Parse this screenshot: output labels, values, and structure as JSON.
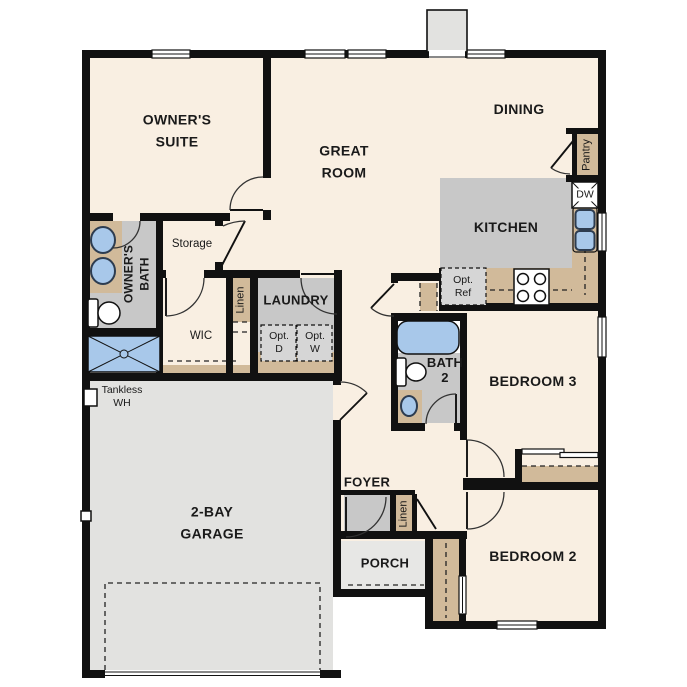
{
  "floorplan": {
    "rooms": {
      "owners_suite": "OWNER'S\nSUITE",
      "great_room": "GREAT\nROOM",
      "dining": "DINING",
      "kitchen": "KITCHEN",
      "laundry": "LAUNDRY",
      "bath2": "BATH\n2",
      "bedroom3": "BEDROOM 3",
      "bedroom2": "BEDROOM 2",
      "foyer": "FOYER",
      "porch": "PORCH",
      "garage": "2-BAY\nGARAGE",
      "wic": "WIC",
      "storage": "Storage",
      "owners_bath": "OWNER'S\nBATH"
    },
    "closets": {
      "linen_upper": "Linen",
      "linen_lower": "Linen",
      "pantry": "Pantry"
    },
    "appliances": {
      "dw": "DW",
      "opt_d": "Opt.\nD",
      "opt_w": "Opt.\nW",
      "opt_ref": "Opt.\nRef",
      "tankless_wh": "Tankless\nWH"
    },
    "colors": {
      "wall": "#111111",
      "floor": "#f9efe2",
      "room_gray": "#c8c8c8",
      "garage": "#e2e2e0",
      "porch": "#e7e7e5",
      "tan": "#d1ba9a",
      "blue": "#a8c8ea"
    }
  }
}
